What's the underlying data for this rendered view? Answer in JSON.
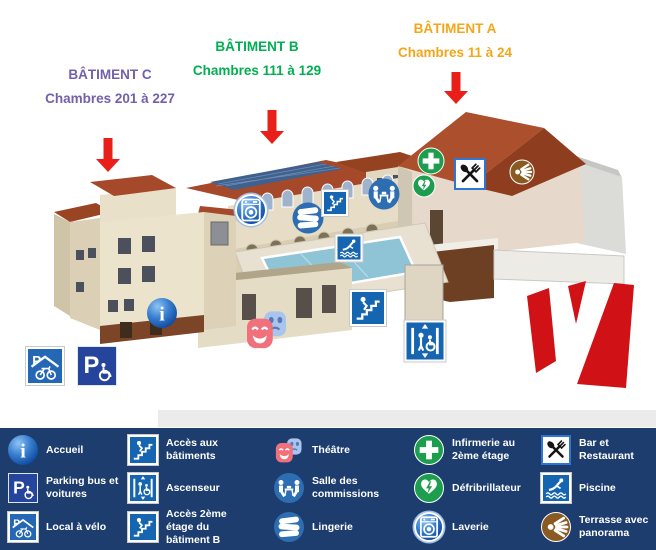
{
  "title_labels": {
    "batiment_c": {
      "name": "BÂTIMENT C",
      "rooms": "Chambres 201 à 227"
    },
    "batiment_b": {
      "name": "BÂTIMENT B",
      "rooms": "Chambres 111 à 129"
    },
    "batiment_a": {
      "name": "BÂTIMENT A",
      "rooms": "Chambres 11 à 24"
    }
  },
  "legend": {
    "items": [
      {
        "icon": "info-icon",
        "label": "Accueil"
      },
      {
        "icon": "parking-icon",
        "label": "Parking bus et voitures"
      },
      {
        "icon": "bike-shed-icon",
        "label": "Local à vélo"
      },
      {
        "icon": "stairs-icon",
        "label": "Accès aux bâtiments"
      },
      {
        "icon": "elevator-icon",
        "label": "Ascenseur"
      },
      {
        "icon": "stairs-icon",
        "label": "Accès 2ème étage du bâtiment B"
      },
      {
        "icon": "theater-masks-icon",
        "label": "Théâtre"
      },
      {
        "icon": "meeting-table-icon",
        "label": "Salle des commissions"
      },
      {
        "icon": "linen-icon",
        "label": "Lingerie"
      },
      {
        "icon": "green-cross-icon",
        "label": "Infirmerie au 2ème étage"
      },
      {
        "icon": "defibrillator-icon",
        "label": "Défribrillateur"
      },
      {
        "icon": "laundry-icon",
        "label": "Laverie"
      },
      {
        "icon": "restaurant-icon",
        "label": "Bar et Restaurant"
      },
      {
        "icon": "swimmer-icon",
        "label": "Piscine"
      },
      {
        "icon": "terrace-sun-icon",
        "label": "Terrasse avec panorama"
      }
    ]
  },
  "map_markers": [
    "accueil",
    "theatre",
    "local-velo",
    "parking",
    "laverie",
    "lingerie",
    "acces-batiments",
    "piscine",
    "salle-commissions",
    "infirmerie",
    "defibrillateur",
    "bar-restaurant",
    "terrasse",
    "acces-2eme-etage",
    "ascenseur"
  ],
  "glyphs": {
    "info": "i",
    "parking": "P",
    "bike": "P"
  },
  "colors": {
    "legend_bg": "#1d3d6f",
    "arrow_red": "#e82019",
    "logo_red": "#d01217",
    "batiment_c_label": "#7161ab",
    "batiment_b_label": "#00b050",
    "batiment_a_label": "#f2a71b",
    "icon_blue": "#2d6db2",
    "sign_blue": "#1565b0",
    "icon_green": "#1d9e4e",
    "icon_brown": "#8a5a23",
    "roof_brown": "#a5492a",
    "wall_cream": "#ece3cd",
    "pool_water": "#8fc4d6"
  }
}
